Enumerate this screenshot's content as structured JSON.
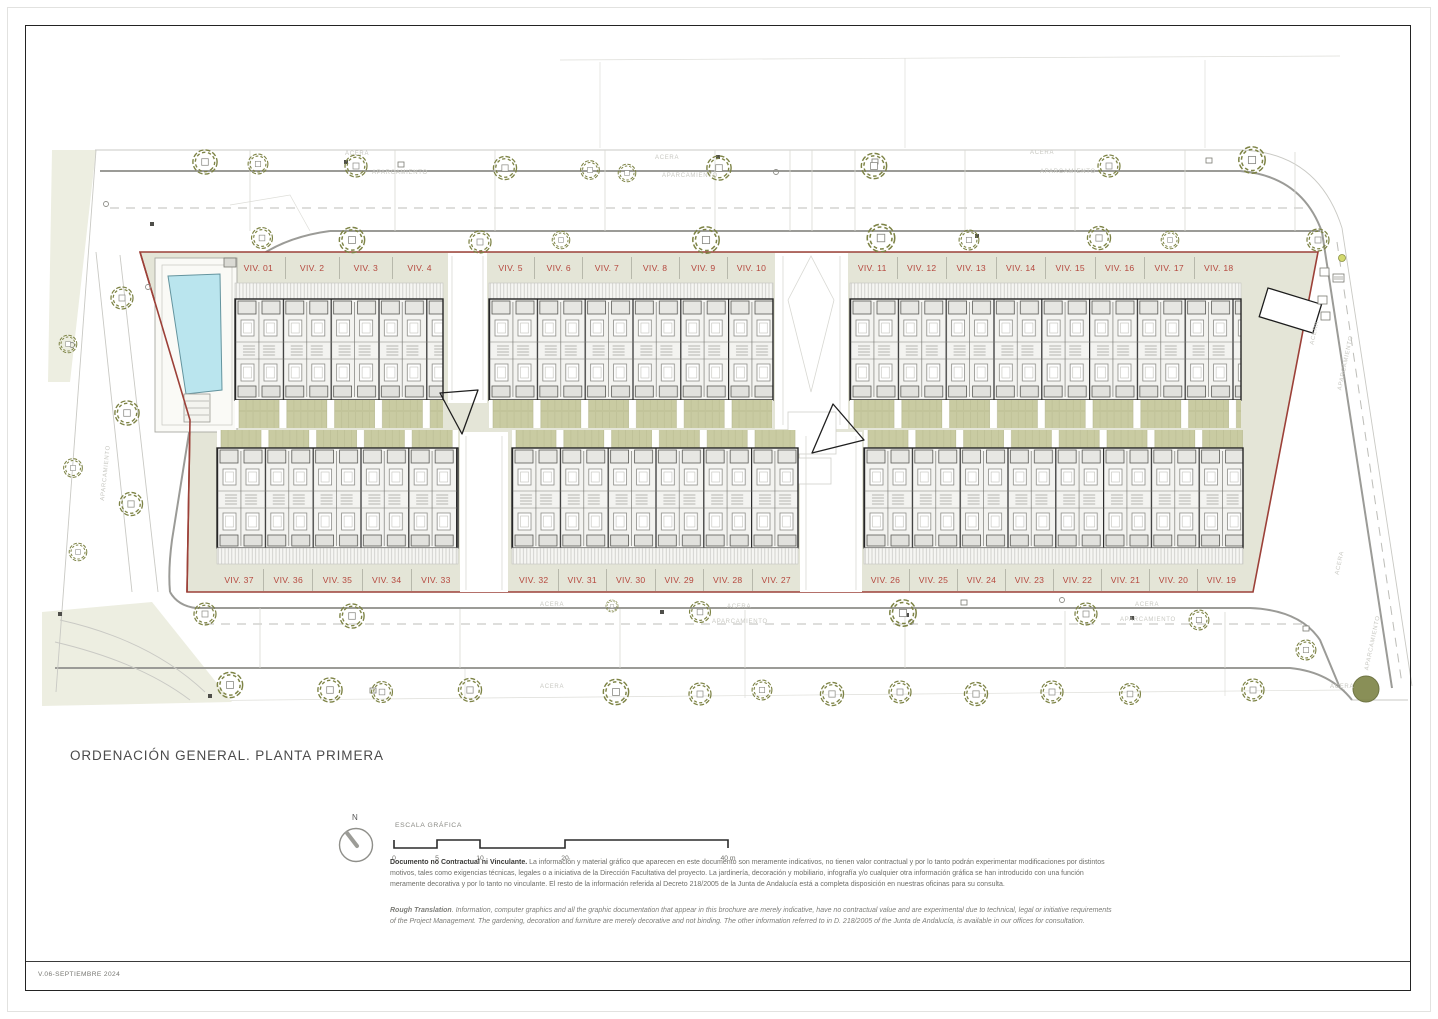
{
  "title": "ORDENACIÓN GENERAL. PLANTA PRIMERA",
  "footer": {
    "version": "V.06-SEPTIEMBRE 2024"
  },
  "north": {
    "label": "N"
  },
  "scale": {
    "title": "ESCALA GRÁFICA",
    "ticks": [
      "0",
      "5",
      "10",
      "20",
      "40 m"
    ]
  },
  "disclaimer": {
    "es_lead": "Documento no Contractual ni Vinculante.",
    "es_body": " La información y material gráfico que aparecen en este documento son meramente indicativos, no tienen valor contractual y por lo tanto podrán experimentar modificaciones por distintos motivos, tales como exigencias técnicas, legales o a iniciativa de la Dirección Facultativa del proyecto. La jardinería, decoración y mobiliario, infografía y/o cualquier otra información gráfica se han introducido con una función meramente decorativa y por lo tanto no vinculante. El resto de la información referida al Decreto 218/2005 de la Junta de Andalucía está a completa disposición en nuestras oficinas para su consulta.",
    "en_lead": "Rough Translation",
    "en_body": ". Information, computer graphics and all the graphic documentation that appear in this brochure are merely indicative, have no contractual value and are experimental due to technical, legal or initiative requirements of the Project Management. The gardening, decoration and furniture are merely decorative and not binding. The other information referred to in D. 218/2005 of the Junta de Andalucía, is available in our offices for consultation."
  },
  "street_labels": {
    "acera": "ACERA",
    "aparcamiento": "APARCAMIENTO"
  },
  "units": {
    "top_a": [
      "VIV. 01",
      "VIV. 2",
      "VIV. 3",
      "VIV. 4"
    ],
    "top_b": [
      "VIV. 5",
      "VIV. 6",
      "VIV. 7",
      "VIV. 8",
      "VIV. 9",
      "VIV. 10"
    ],
    "top_c": [
      "VIV. 11",
      "VIV. 12",
      "VIV. 13",
      "VIV. 14",
      "VIV. 15",
      "VIV. 16",
      "VIV. 17",
      "VIV. 18"
    ],
    "bottom_a": [
      "VIV. 37",
      "VIV. 36",
      "VIV. 35",
      "VIV. 34",
      "VIV. 33"
    ],
    "bottom_b": [
      "VIV. 32",
      "VIV. 31",
      "VIV. 30",
      "VIV. 29",
      "VIV. 28",
      "VIV. 27"
    ],
    "bottom_c": [
      "VIV. 26",
      "VIV. 25",
      "VIV. 24",
      "VIV. 23",
      "VIV. 22",
      "VIV. 21",
      "VIV. 20",
      "VIV. 19"
    ]
  },
  "colors": {
    "site_fill": "#e4e5d7",
    "boundary_red": "#9c4038",
    "unit_label_red": "#b5483e",
    "tree_olive": "#7d8345",
    "terrace_olive": "#c9cba2",
    "pool_blue": "#bae5ee",
    "street_gray": "#9b9b97",
    "faint_text": "#c8c8c2"
  }
}
